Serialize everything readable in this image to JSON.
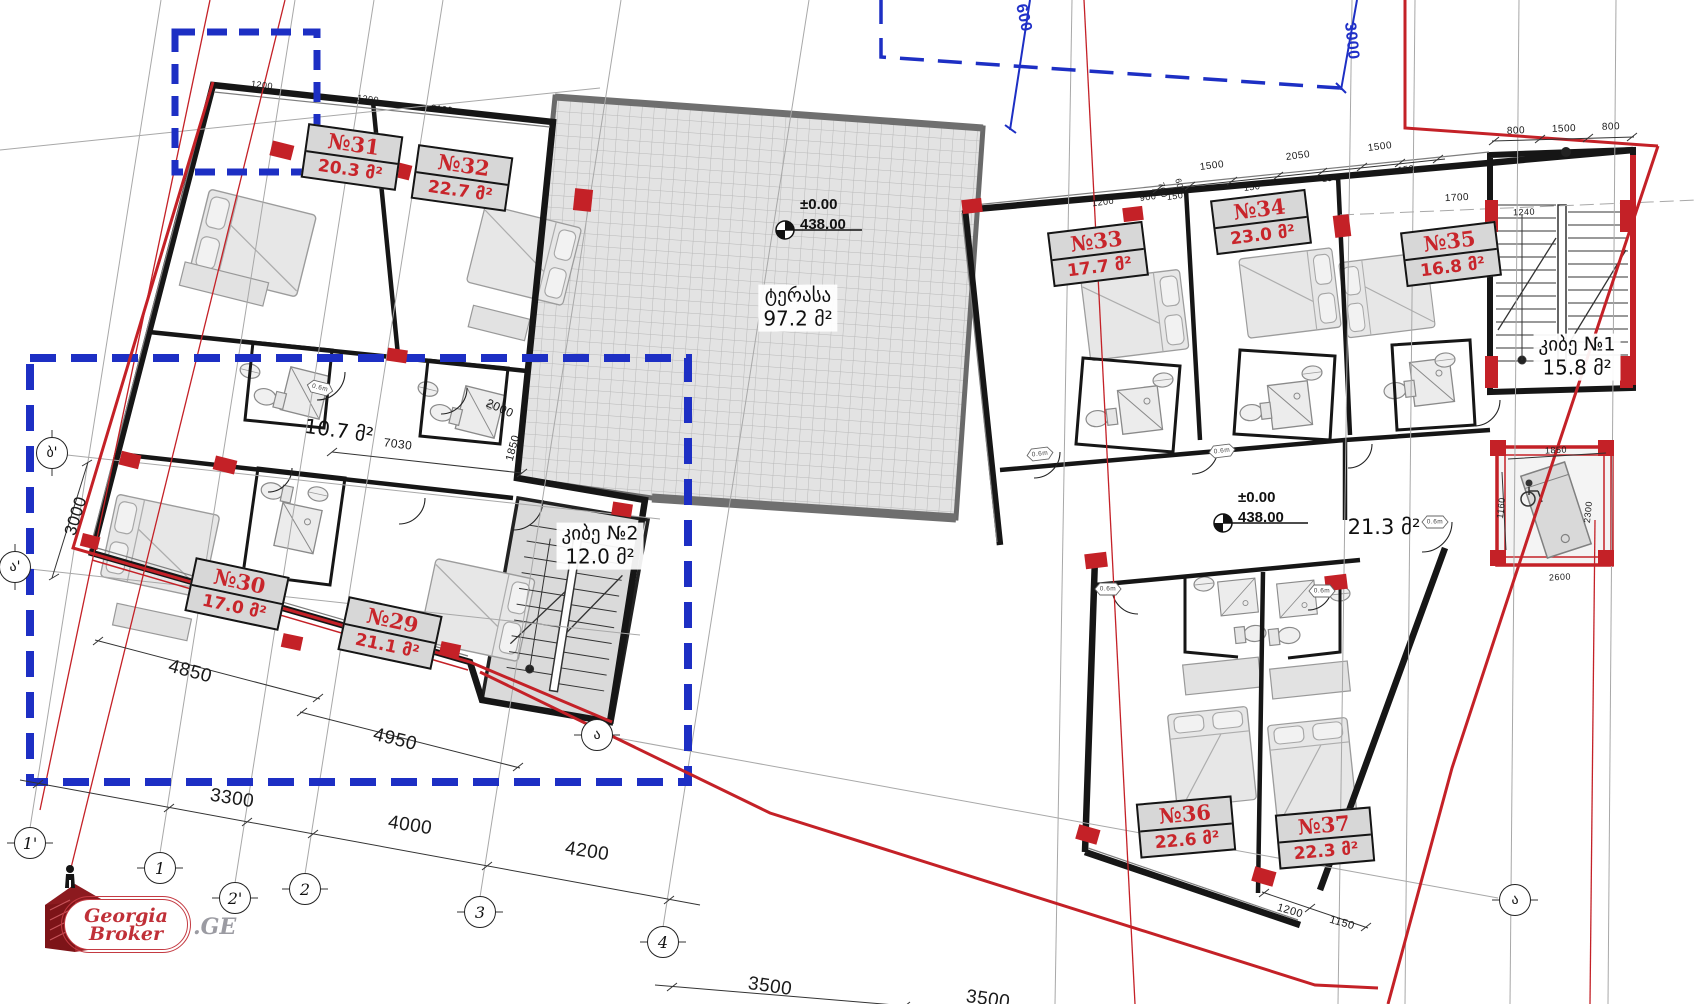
{
  "rooms": [
    {
      "number": "№29",
      "area": "21.1 მ²"
    },
    {
      "number": "№30",
      "area": "17.0 მ²"
    },
    {
      "number": "№31",
      "area": "20.3 მ²"
    },
    {
      "number": "№32",
      "area": "22.7 მ²"
    },
    {
      "number": "№33",
      "area": "17.7 მ²"
    },
    {
      "number": "№34",
      "area": "23.0 მ²"
    },
    {
      "number": "№35",
      "area": "16.8 მ²"
    },
    {
      "number": "№36",
      "area": "22.6 მ²"
    },
    {
      "number": "№37",
      "area": "22.3 მ²"
    }
  ],
  "spaces": {
    "terrace_name": "ტერასა",
    "terrace_area": "97.2 მ²",
    "stair1_name": "კიბე №1",
    "stair1_area": "15.8 მ²",
    "stair2_name": "კიბე №2",
    "stair2_area": "12.0 მ²",
    "hall_left_area": "10.7 მ²",
    "hall_right_area": "21.3 მ²"
  },
  "elevation": {
    "level": "±0.00",
    "datum": "438.00"
  },
  "axes": [
    "1'",
    "1",
    "2'",
    "2",
    "3",
    "4",
    "ა",
    "ბ'",
    "ა'",
    "ა"
  ],
  "dims": {
    "site": [
      "3300",
      "4000",
      "4200",
      "3500",
      "3500"
    ],
    "left_wall": [
      "4850",
      "4950"
    ],
    "left_v": "3000",
    "interior_left": [
      "7030",
      "2000",
      "1850",
      "1200",
      "1200",
      "2100"
    ],
    "blue": [
      "600",
      "3000"
    ],
    "top_spans": [
      "1500",
      "2050",
      "1500"
    ],
    "top_seg": [
      "150",
      "150",
      "150",
      "150"
    ],
    "top_small": [
      "1200",
      "900",
      "700",
      "600",
      "1700",
      "1240"
    ],
    "stair_top": [
      "800",
      "1500",
      "800"
    ],
    "elevator": [
      "1850",
      "1160",
      "2300",
      "2600"
    ],
    "bottom_right": [
      "1200",
      "1150"
    ]
  },
  "door_tag": {
    "width": "0.6m",
    "height": "2.20"
  },
  "logo": {
    "word1": "Georgia",
    "word2": "Broker",
    "suffix": ".GE"
  },
  "colors": {
    "boundary_red": "#c42127",
    "axis_blue": "#2030c8",
    "label_red": "#c8252b",
    "wall_black": "#161616"
  }
}
